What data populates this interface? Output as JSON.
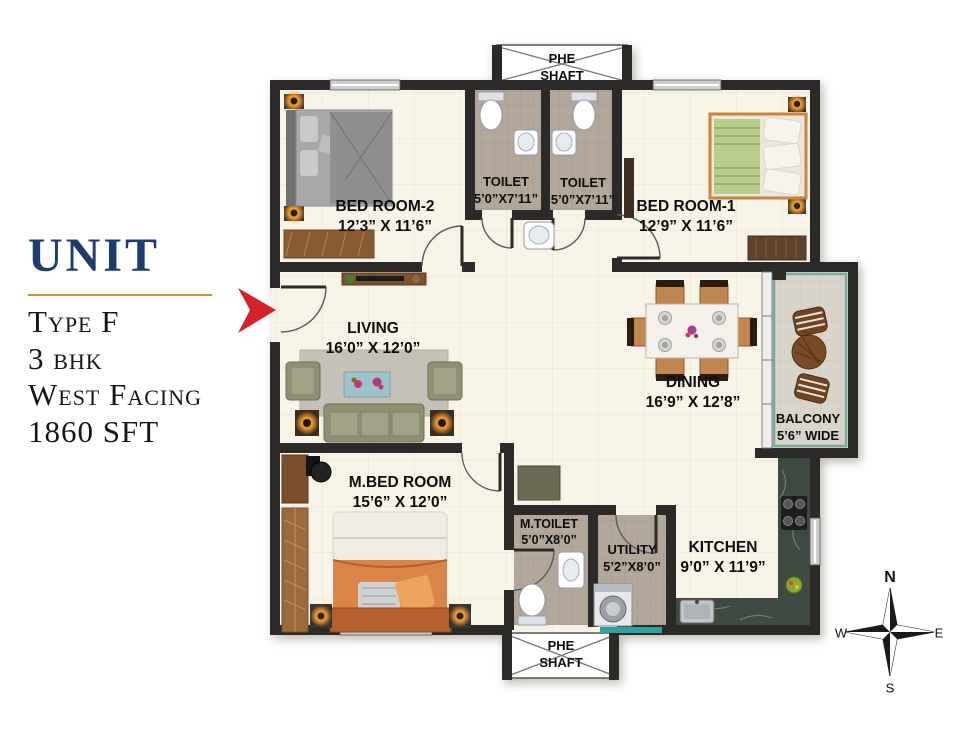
{
  "info_panel": {
    "title": "UNIT",
    "type": "Type F",
    "bhk": "3 bhk",
    "facing": "West Facing",
    "area": "1860 SFT"
  },
  "rooms": {
    "phe_shaft_top": {
      "line1": "PHE",
      "line2": "SHAFT"
    },
    "toilet_left": {
      "label": "TOILET",
      "dims": "5’0”X7’11”"
    },
    "toilet_right": {
      "label": "TOILET",
      "dims": "5’0”X7’11”"
    },
    "bedroom2": {
      "label": "BED ROOM-2",
      "dims": "12’3” X 11’6”"
    },
    "bedroom1": {
      "label": "BED ROOM-1",
      "dims": "12’9” X 11’6”"
    },
    "living": {
      "label": "LIVING",
      "dims": "16’0” X 12’0”"
    },
    "dining": {
      "label": "DINING",
      "dims": "16’9” X 12’8”"
    },
    "balcony": {
      "label": "BALCONY",
      "dims": "5’6” WIDE"
    },
    "master_bedroom": {
      "label": "M.BED ROOM",
      "dims": "15’6” X 12’0”"
    },
    "master_toilet": {
      "label": "M.TOILET",
      "dims": "5’0”X8’0”"
    },
    "utility": {
      "label": "UTILITY",
      "dims": "5’2”X8’0”"
    },
    "kitchen": {
      "label": "KITCHEN",
      "dims": "9’0” X 11’9”"
    },
    "phe_shaft_bottom": {
      "line1": "PHE",
      "line2": "SHAFT"
    }
  },
  "compass": {
    "north": "N",
    "east": "E",
    "south": "S",
    "west": "W"
  },
  "colors": {
    "wall": "#2b2a28",
    "floor": "#f8f3e7",
    "wet_tile": "#b3a79a",
    "granite": "#3c4a42",
    "accent_red": "#d7212a",
    "title_navy": "#1d3c6d",
    "gold_rule": "#c8962b"
  }
}
